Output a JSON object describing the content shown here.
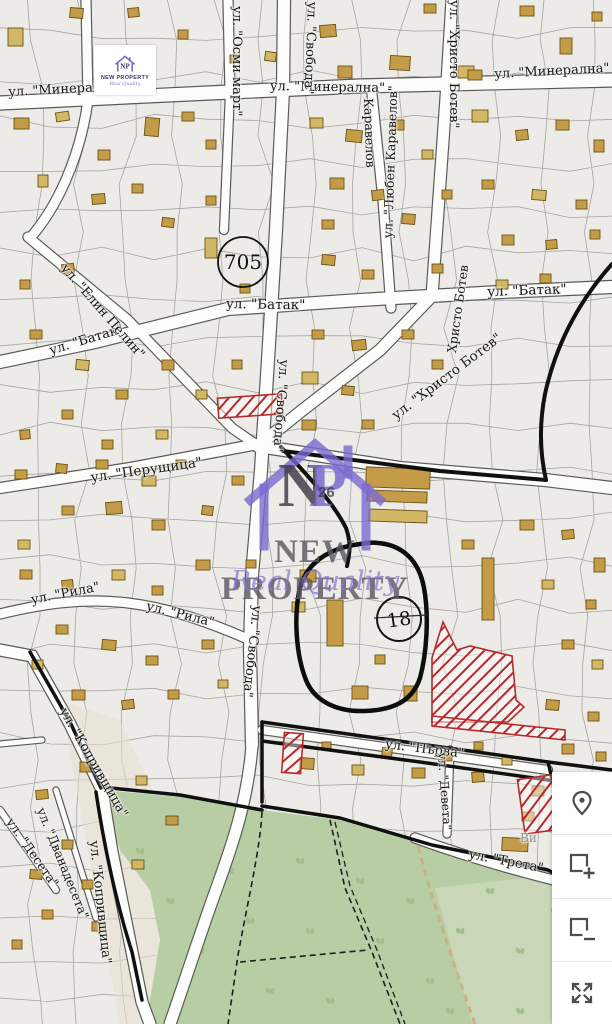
{
  "logo": {
    "np": "NP",
    "title": "NEW PROPERTY",
    "subtitle": "Real Quality"
  },
  "watermark": {
    "np_n": "N",
    "np_p": "P",
    "number": "26",
    "title": "NEW PROPERTY",
    "subtitle": "Real Quality"
  },
  "zones": {
    "z705": "705",
    "z18": "18"
  },
  "street_labels": [
    {
      "text": "ул. \"Минерална\"",
      "x": 8,
      "y": 86,
      "rot": -3,
      "size": 13
    },
    {
      "text": "ул. \"Минерална\"",
      "x": 270,
      "y": 80,
      "rot": 1,
      "size": 13
    },
    {
      "text": "ул. \"Минерална\"",
      "x": 494,
      "y": 68,
      "rot": -3,
      "size": 13
    },
    {
      "text": "ул. \"Осми март\"",
      "x": 243,
      "y": 6,
      "rot": 90,
      "size": 13
    },
    {
      "text": "ул. \"Свобода\"",
      "x": 318,
      "y": 2,
      "rot": 92,
      "size": 13
    },
    {
      "text": "ул. \"Свобода\"",
      "x": 290,
      "y": 360,
      "rot": 94,
      "size": 13
    },
    {
      "text": "ул. \"Свобода\"",
      "x": 263,
      "y": 606,
      "rot": 96,
      "size": 13
    },
    {
      "text": "ул. \"Батак\"",
      "x": 48,
      "y": 345,
      "rot": -17,
      "size": 13
    },
    {
      "text": "ул. \"Батак\"",
      "x": 226,
      "y": 298,
      "rot": 1,
      "size": 13.5
    },
    {
      "text": "ул. \"Батак\"",
      "x": 487,
      "y": 286,
      "rot": -2,
      "size": 13.5
    },
    {
      "text": "ул. \"Елин Пелин\"",
      "x": 68,
      "y": 262,
      "rot": 49,
      "size": 13
    },
    {
      "text": "Каравелов",
      "x": 374,
      "y": 98,
      "rot": 88,
      "size": 12.5
    },
    {
      "text": "ул. \"Любен Каравелов\"",
      "x": 382,
      "y": 238,
      "rot": -88,
      "size": 12.5
    },
    {
      "text": "ул. \"Христо Ботев\"",
      "x": 460,
      "y": 0,
      "rot": 90,
      "size": 13
    },
    {
      "text": "Христо Ботев",
      "x": 446,
      "y": 352,
      "rot": -82,
      "size": 12.5
    },
    {
      "text": "ул. \"Христо Ботев\"",
      "x": 390,
      "y": 412,
      "rot": -37,
      "size": 13.5
    },
    {
      "text": "ул. \"Перущица\"",
      "x": 90,
      "y": 472,
      "rot": -8,
      "size": 13.5
    },
    {
      "text": "ул. \"Рила\"",
      "x": 30,
      "y": 594,
      "rot": -11,
      "size": 13
    },
    {
      "text": "ул. \"Рила\"",
      "x": 148,
      "y": 600,
      "rot": 14,
      "size": 13
    },
    {
      "text": "ул. \"Копривщица\"",
      "x": 68,
      "y": 706,
      "rot": 60,
      "size": 13
    },
    {
      "text": "ул. \"Копривщица\"",
      "x": 100,
      "y": 840,
      "rot": 84,
      "size": 13
    },
    {
      "text": "ул. \"Десета\"",
      "x": 14,
      "y": 816,
      "rot": 55,
      "size": 12.5
    },
    {
      "text": "ул. \"Дванадесета\"",
      "x": 46,
      "y": 806,
      "rot": 68,
      "size": 12.5
    },
    {
      "text": "ул. \"Първа\"",
      "x": 386,
      "y": 738,
      "rot": 7,
      "size": 13
    },
    {
      "text": "ул. \"Девета\"",
      "x": 448,
      "y": 752,
      "rot": 86,
      "size": 12
    },
    {
      "text": "ул. \"Трета\"",
      "x": 470,
      "y": 848,
      "rot": 11,
      "size": 13
    },
    {
      "text": "Ви",
      "x": 520,
      "y": 832,
      "rot": 0,
      "size": 12,
      "color": "#8f8f8f"
    }
  ],
  "controls": {
    "buttons": [
      {
        "name": "locate",
        "icon": "map-pin-icon"
      },
      {
        "name": "add-area",
        "icon": "square-plus-icon"
      },
      {
        "name": "remove-area",
        "icon": "square-minus-icon"
      },
      {
        "name": "fullscreen",
        "icon": "fullscreen-arrows-icon"
      }
    ]
  },
  "colors": {
    "building": "#c49b47",
    "building_alt": "#d2b765",
    "green_area": "#b7cda3",
    "road": "#fcfcfa",
    "boundary": "#101010",
    "hatch_red": "#b52b2b",
    "watermark_purple": "#7b6ad0",
    "logo_navy": "#3c3766"
  }
}
